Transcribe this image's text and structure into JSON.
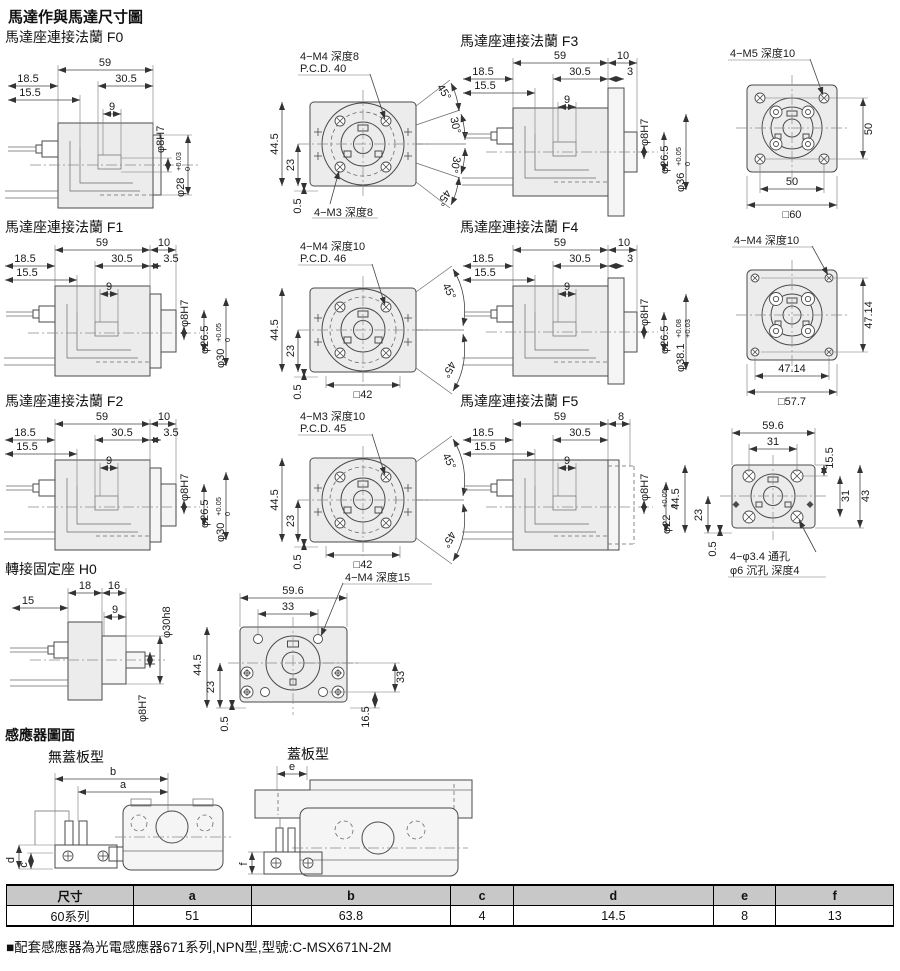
{
  "title": "馬達作與馬達尺寸圖",
  "sections": {
    "f0": {
      "label": "馬達座連接法蘭 F0",
      "side": {
        "len": "59",
        "mid": "30.5",
        "left1": "18.5",
        "left2": "15.5",
        "key": "9",
        "shaft": "φ8H7",
        "pilot": "φ28",
        "tol_top": "+0.03",
        "tol_bot": "0"
      },
      "front": {
        "callout_top1": "4−M4 深度8",
        "callout_top2": "P.C.D. 40",
        "callout_bottom": "4−M3 深度8",
        "height": "44.5",
        "center": "23",
        "off": "0.5",
        "angles": [
          "45°",
          "30°",
          "30°",
          "45°"
        ]
      }
    },
    "f1": {
      "label": "馬達座連接法蘭 F1",
      "side": {
        "len": "59",
        "flange": "10",
        "mid": "30.5",
        "step": "3.5",
        "left1": "18.5",
        "left2": "15.5",
        "key": "9",
        "shaft": "φ8H7",
        "boss": "φ26.5",
        "pilot": "φ30",
        "tol_top": "+0.05",
        "tol_bot": "0"
      },
      "front": {
        "callout_top1": "4−M4 深度10",
        "callout_top2": "P.C.D. 46",
        "height": "44.5",
        "center": "23",
        "off": "0.5",
        "square": "□42",
        "angles": [
          "45°",
          "45°"
        ]
      }
    },
    "f2": {
      "label": "馬達座連接法蘭 F2",
      "side": {
        "len": "59",
        "flange": "10",
        "mid": "30.5",
        "step": "3.5",
        "left1": "18.5",
        "left2": "15.5",
        "key": "9",
        "shaft": "φ8H7",
        "boss": "φ26.5",
        "pilot": "φ30",
        "tol_top": "+0.05",
        "tol_bot": "0"
      },
      "front": {
        "callout_top1": "4−M3 深度10",
        "callout_top2": "P.C.D. 45",
        "height": "44.5",
        "center": "23",
        "off": "0.5",
        "square": "□42",
        "angles": [
          "45°",
          "45°"
        ]
      }
    },
    "f3": {
      "label": "馬達座連接法蘭 F3",
      "side": {
        "len": "59",
        "flange": "10",
        "mid": "30.5",
        "step": "3",
        "left1": "18.5",
        "left2": "15.5",
        "key": "9",
        "shaft": "φ8H7",
        "boss": "φ26.5",
        "pilot": "φ36",
        "tol_top": "+0.05",
        "tol_bot": "0"
      },
      "front": {
        "callout_top": "4−M5 深度10",
        "v": "50",
        "h": "50",
        "square": "□60"
      }
    },
    "f4": {
      "label": "馬達座連接法蘭 F4",
      "side": {
        "len": "59",
        "flange": "10",
        "mid": "30.5",
        "step": "3",
        "left1": "18.5",
        "left2": "15.5",
        "key": "9",
        "shaft": "φ8H7",
        "boss": "φ26.5",
        "pilot": "φ38.1",
        "tol_top": "+0.08",
        "tol_bot": "+0.03"
      },
      "front": {
        "callout_top": "4−M4 深度10",
        "v": "47.14",
        "h": "47.14",
        "square": "□57.7"
      }
    },
    "f5": {
      "label": "馬達座連接法蘭 F5",
      "side": {
        "len": "59",
        "flange": "8",
        "mid": "30.5",
        "left1": "18.5",
        "left2": "15.5",
        "key": "9",
        "shaft": "φ8H7",
        "pilot": "φ22",
        "tol_top": "+0.05",
        "tol_bot": "0"
      },
      "front": {
        "width": "59.6",
        "inner_h": "31",
        "corner": "15.5",
        "height": "44.5",
        "center": "23",
        "off": "0.5",
        "inner_v": "31",
        "total_v": "43",
        "callout1": "4−φ3.4 通孔",
        "callout2": "φ6 沉孔 深度4"
      }
    },
    "h0": {
      "label": "轉接固定座 H0",
      "side": {
        "d18": "18",
        "d16": "16",
        "d15": "15",
        "key": "9",
        "boss": "φ30h8",
        "shaft": "φ8H7"
      },
      "front": {
        "width": "59.6",
        "inner_h": "33",
        "callout": "4−M4 深度15",
        "height": "44.5",
        "center": "23",
        "off": "0.5",
        "inner_v": "33",
        "bottom": "16.5"
      }
    },
    "sensor": {
      "label": "感應器圖面",
      "left": {
        "label": "無蓋板型",
        "a": "a",
        "b": "b",
        "c": "c",
        "d": "d"
      },
      "right": {
        "label": "蓋板型",
        "e": "e",
        "f": "f"
      }
    }
  },
  "table": {
    "headers": [
      "尺寸",
      "a",
      "b",
      "c",
      "d",
      "e",
      "f"
    ],
    "rows": [
      [
        "60系列",
        "51",
        "63.8",
        "4",
        "14.5",
        "8",
        "13"
      ]
    ]
  },
  "note": "■配套感應器為光電感應器671系列,NPN型,型號:C-MSX671N-2M"
}
